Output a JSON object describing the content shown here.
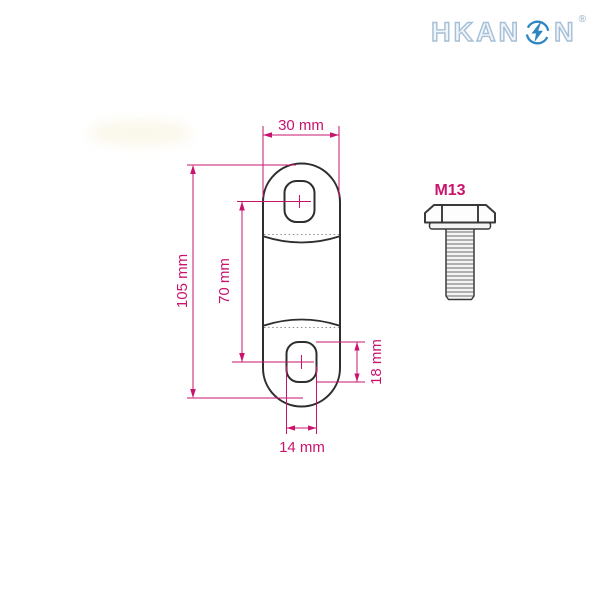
{
  "logo": {
    "part1": "HKAN",
    "part2": "N",
    "registered": "®",
    "icon": "lightning-bolt-in-circle-icon"
  },
  "bolt": {
    "label": "M13"
  },
  "dimensions": {
    "plate_width": "30 mm",
    "plate_height": "105 mm",
    "hole_spacing": "70 mm",
    "hole_height": "18 mm",
    "hole_width": "14 mm"
  },
  "colors": {
    "dimension": "#c9146e",
    "outline": "#2e2e2e",
    "logo_outline": "#a6bfd6",
    "logo_accent": "#2e86c1"
  }
}
